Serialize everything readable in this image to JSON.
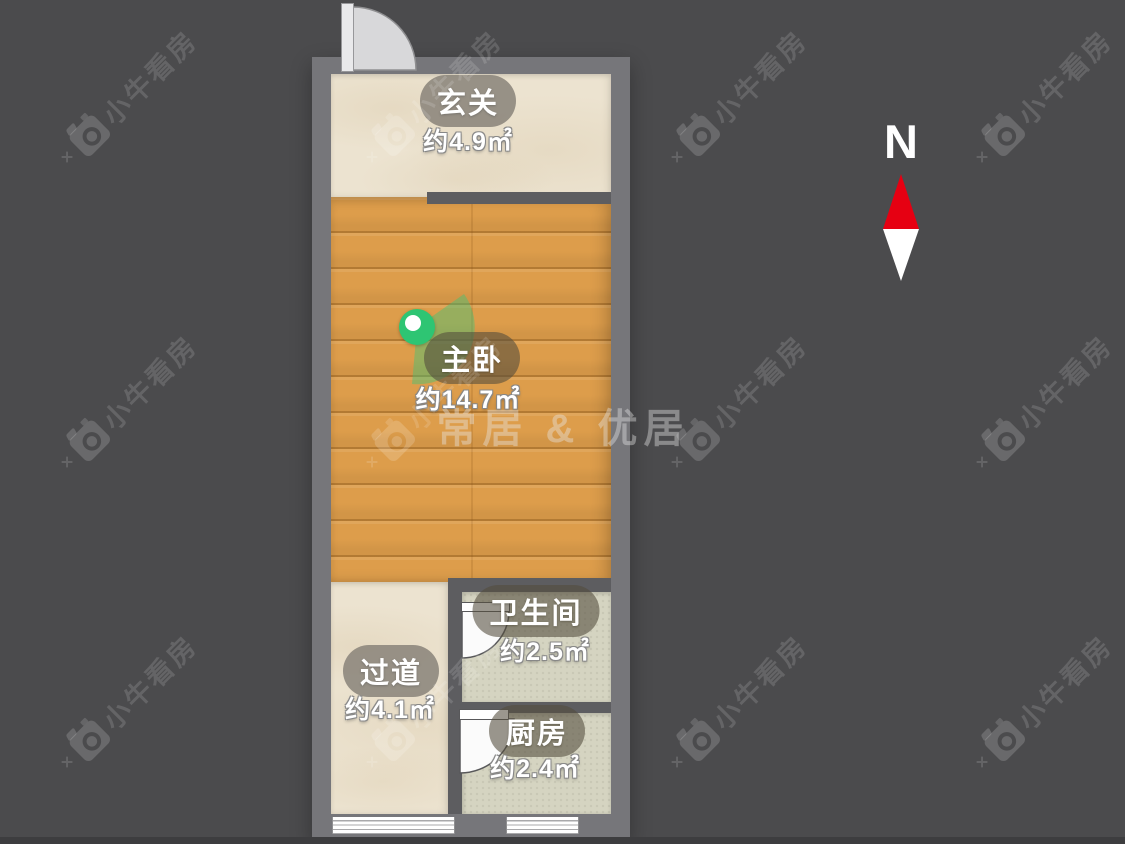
{
  "compass": {
    "label": "N"
  },
  "rooms": [
    {
      "id": "entry",
      "name": "玄关",
      "area": "约4.9㎡"
    },
    {
      "id": "master-bedroom",
      "name": "主卧",
      "area": "约14.7㎡"
    },
    {
      "id": "hallway",
      "name": "过道",
      "area": "约4.1㎡"
    },
    {
      "id": "bathroom",
      "name": "卫生间",
      "area": "约2.5㎡"
    },
    {
      "id": "kitchen",
      "name": "厨房",
      "area": "约2.4㎡"
    }
  ],
  "watermarks": {
    "center_brand": "常居 & 优居",
    "tile_brand": "小牛看房",
    "tile_positions": [
      [
        75,
        145
      ],
      [
        380,
        145
      ],
      [
        685,
        145
      ],
      [
        990,
        145
      ],
      [
        75,
        450
      ],
      [
        380,
        450
      ],
      [
        685,
        450
      ],
      [
        990,
        450
      ],
      [
        75,
        750
      ],
      [
        380,
        750
      ],
      [
        685,
        750
      ],
      [
        990,
        750
      ]
    ]
  },
  "colors": {
    "background": "#4b4b4d",
    "wall": "#76767a",
    "wall_dark": "#5d5d60",
    "wood_floor": "#dd9d4b",
    "tile_beige": "#ece3d0",
    "tile_green": "#d5d4c1",
    "marker_green": "#2ec573",
    "north_red": "#e60012"
  }
}
